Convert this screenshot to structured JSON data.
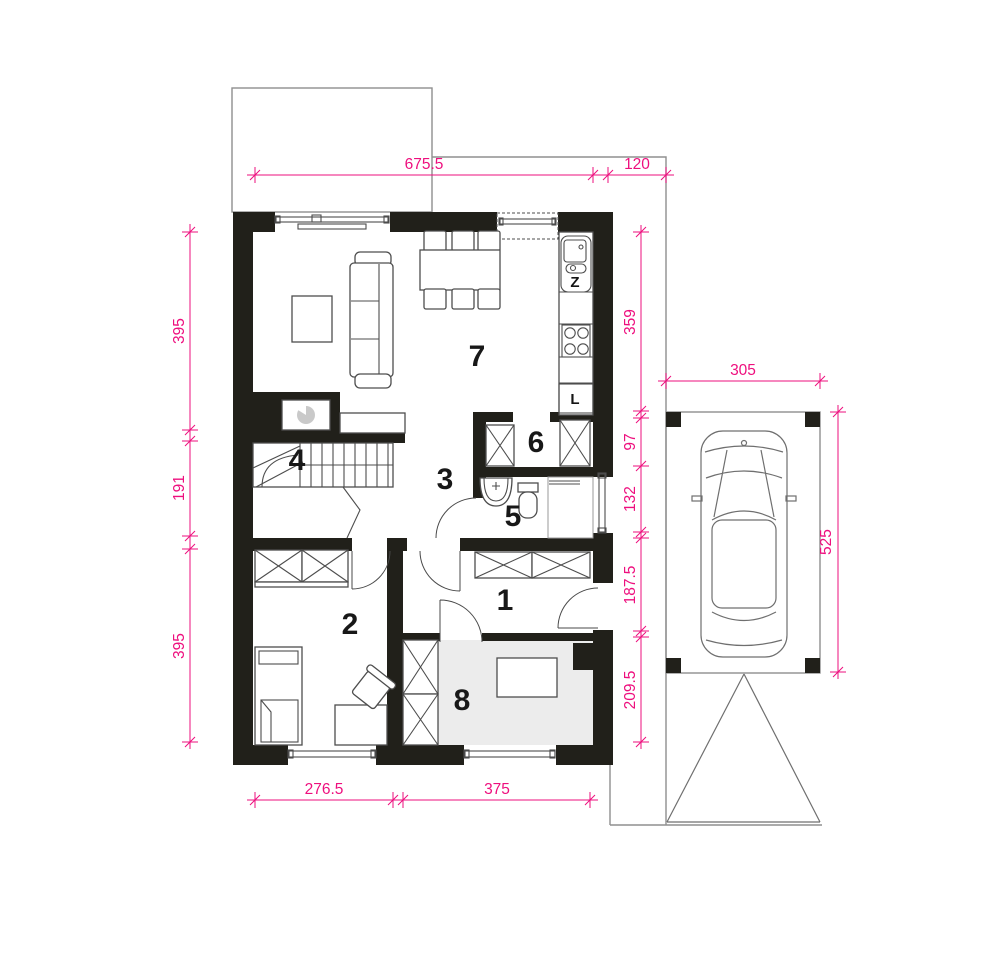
{
  "floor_plan": {
    "room_numbers": [
      "1",
      "2",
      "3",
      "4",
      "5",
      "6",
      "7",
      "8"
    ],
    "appliance_labels": {
      "sink": "Z",
      "fridge": "L"
    },
    "dimensions_cm": {
      "top_interior_width": "675.5",
      "top_side_offset": "120",
      "left_upper": "395",
      "left_middle": "191",
      "left_lower": "395",
      "right_kitchen": "359",
      "right_closet": "97",
      "right_bath": "132",
      "right_hall": "187.5",
      "right_utility": "209.5",
      "carport_width": "305",
      "carport_depth": "525",
      "bottom_room2": "276.5",
      "bottom_room8": "375"
    },
    "colors": {
      "wall": "#21201a",
      "dimension": "#ee0f7e",
      "room8_floor": "#ececec",
      "outline": "#8f8f8f"
    }
  }
}
